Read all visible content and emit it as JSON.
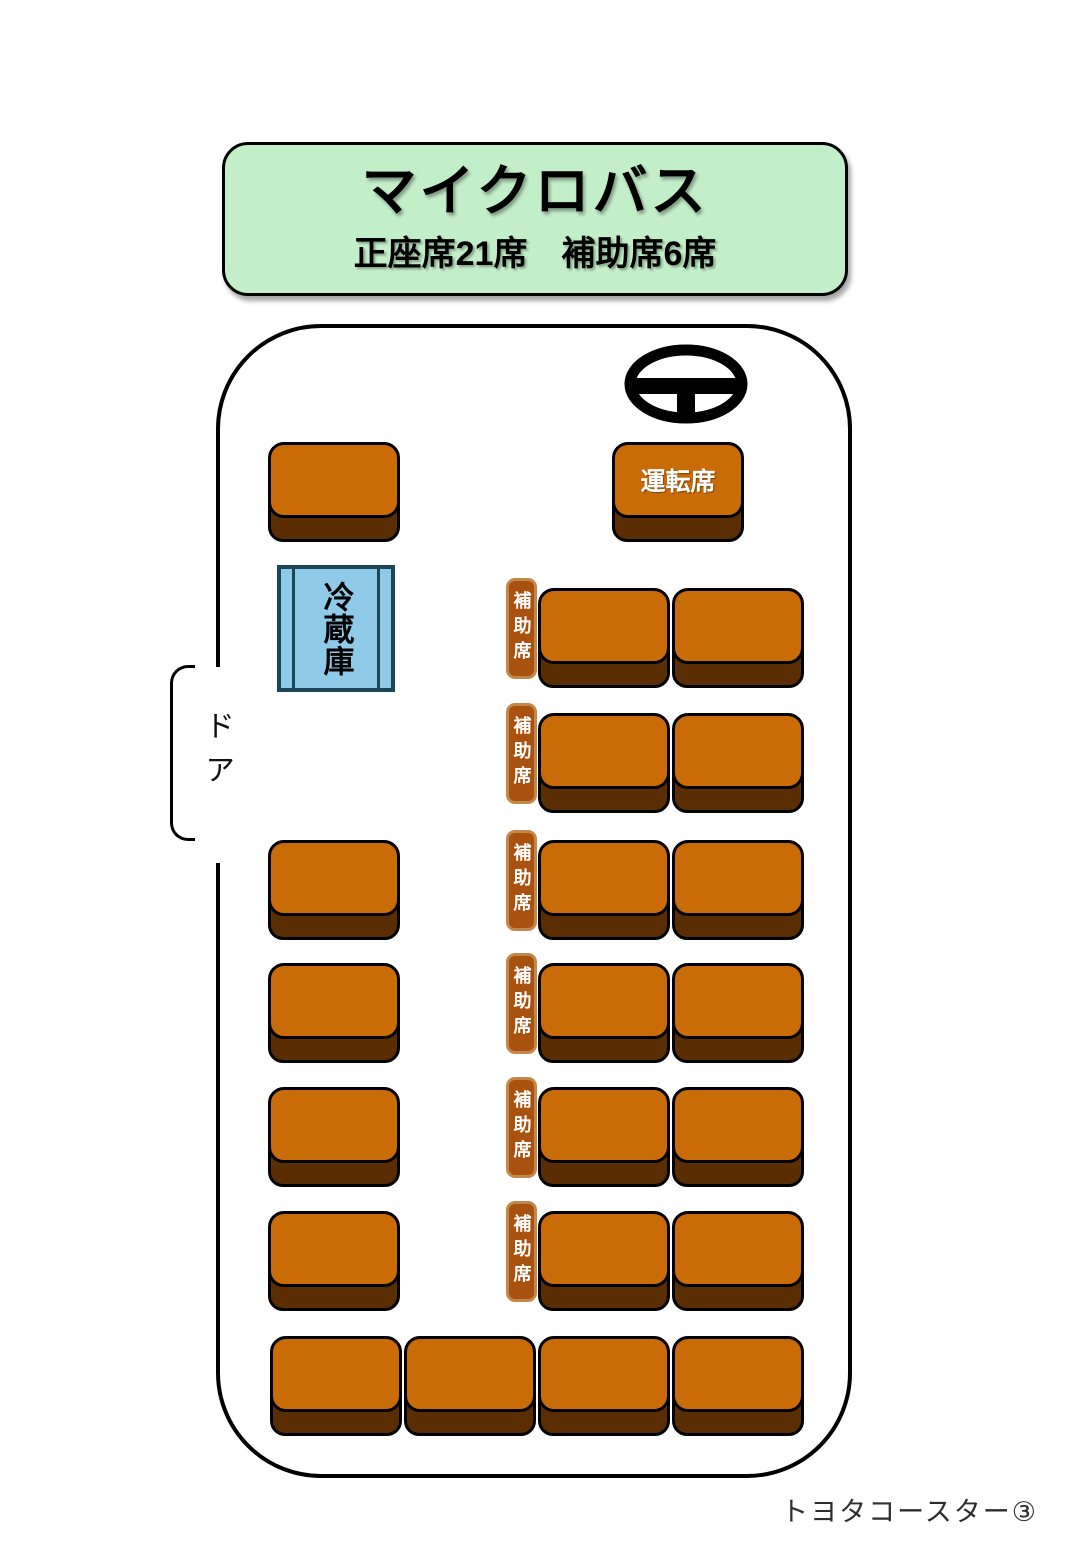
{
  "header": {
    "title": "マイクロバス",
    "subtitle": "正座席21席　補助席6席"
  },
  "driver_seat": {
    "label": "運転席"
  },
  "fridge": {
    "label": "冷蔵庫"
  },
  "door": {
    "label": "ドア"
  },
  "aux_seat": {
    "label": "補助席",
    "count": 6
  },
  "seating": {
    "regular_seats": 21,
    "aux_seats": 6
  },
  "footer": {
    "label": "トヨタコースター③"
  },
  "icons": {
    "steering_wheel": "steering-wheel"
  },
  "colors": {
    "header_bg": "#C2EEC8",
    "seat": "#C96B06",
    "seat_base": "#5B2D02",
    "aux_fill": "#A9510F",
    "aux_border": "#C4874A",
    "fridge_fill": "#8FCBE8",
    "fridge_border": "#1B4758"
  }
}
